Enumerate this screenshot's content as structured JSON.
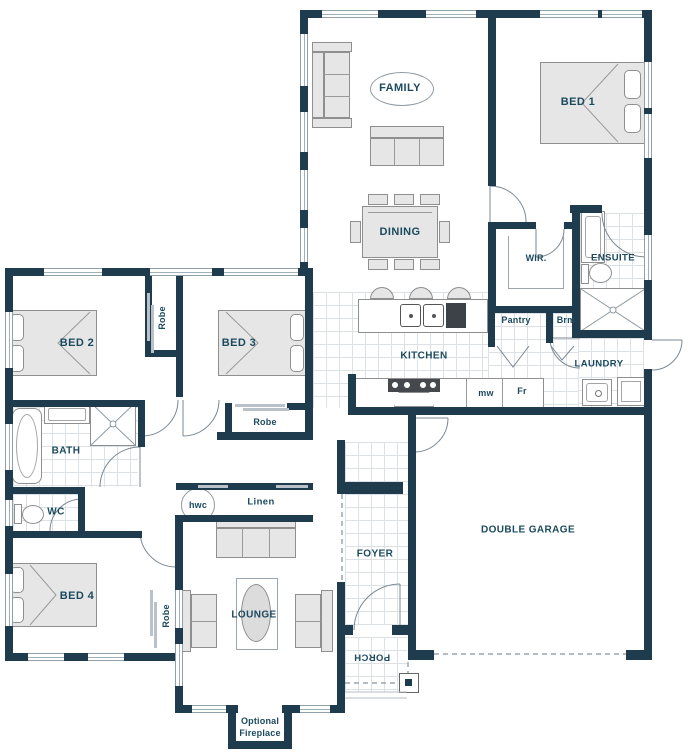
{
  "title": "Single storey house floor plan",
  "colors": {
    "wall": "#1e3c4e",
    "label": "#1b4a5e",
    "furniture_fill": "#e6e6e6",
    "fixture_line": "#8f9aa2",
    "tile_line": "#dbe1e5"
  },
  "rooms": {
    "family": "FAMILY",
    "bed1": "BED 1",
    "dining": "DINING",
    "wir": "WIR.",
    "ensuite": "ENSUITE",
    "pantry": "Pantry",
    "broom": "Brm",
    "kitchen": "KITCHEN",
    "laundry": "LAUNDRY",
    "microwave": "mw",
    "fridge": "Fr",
    "bed2": "BED 2",
    "robe_mid": "Robe",
    "bed3": "BED 3",
    "robe_bed3": "Robe",
    "bath": "BATH",
    "wc": "WC",
    "hwc": "hwc",
    "linen": "Linen",
    "bed4": "BED 4",
    "robe_bed4": "Robe",
    "lounge": "LOUNGE",
    "foyer": "FOYER",
    "porch": "PORCH",
    "garage": "DOUBLE GARAGE",
    "fireplace_line1": "Optional",
    "fireplace_line2": "Fireplace"
  }
}
